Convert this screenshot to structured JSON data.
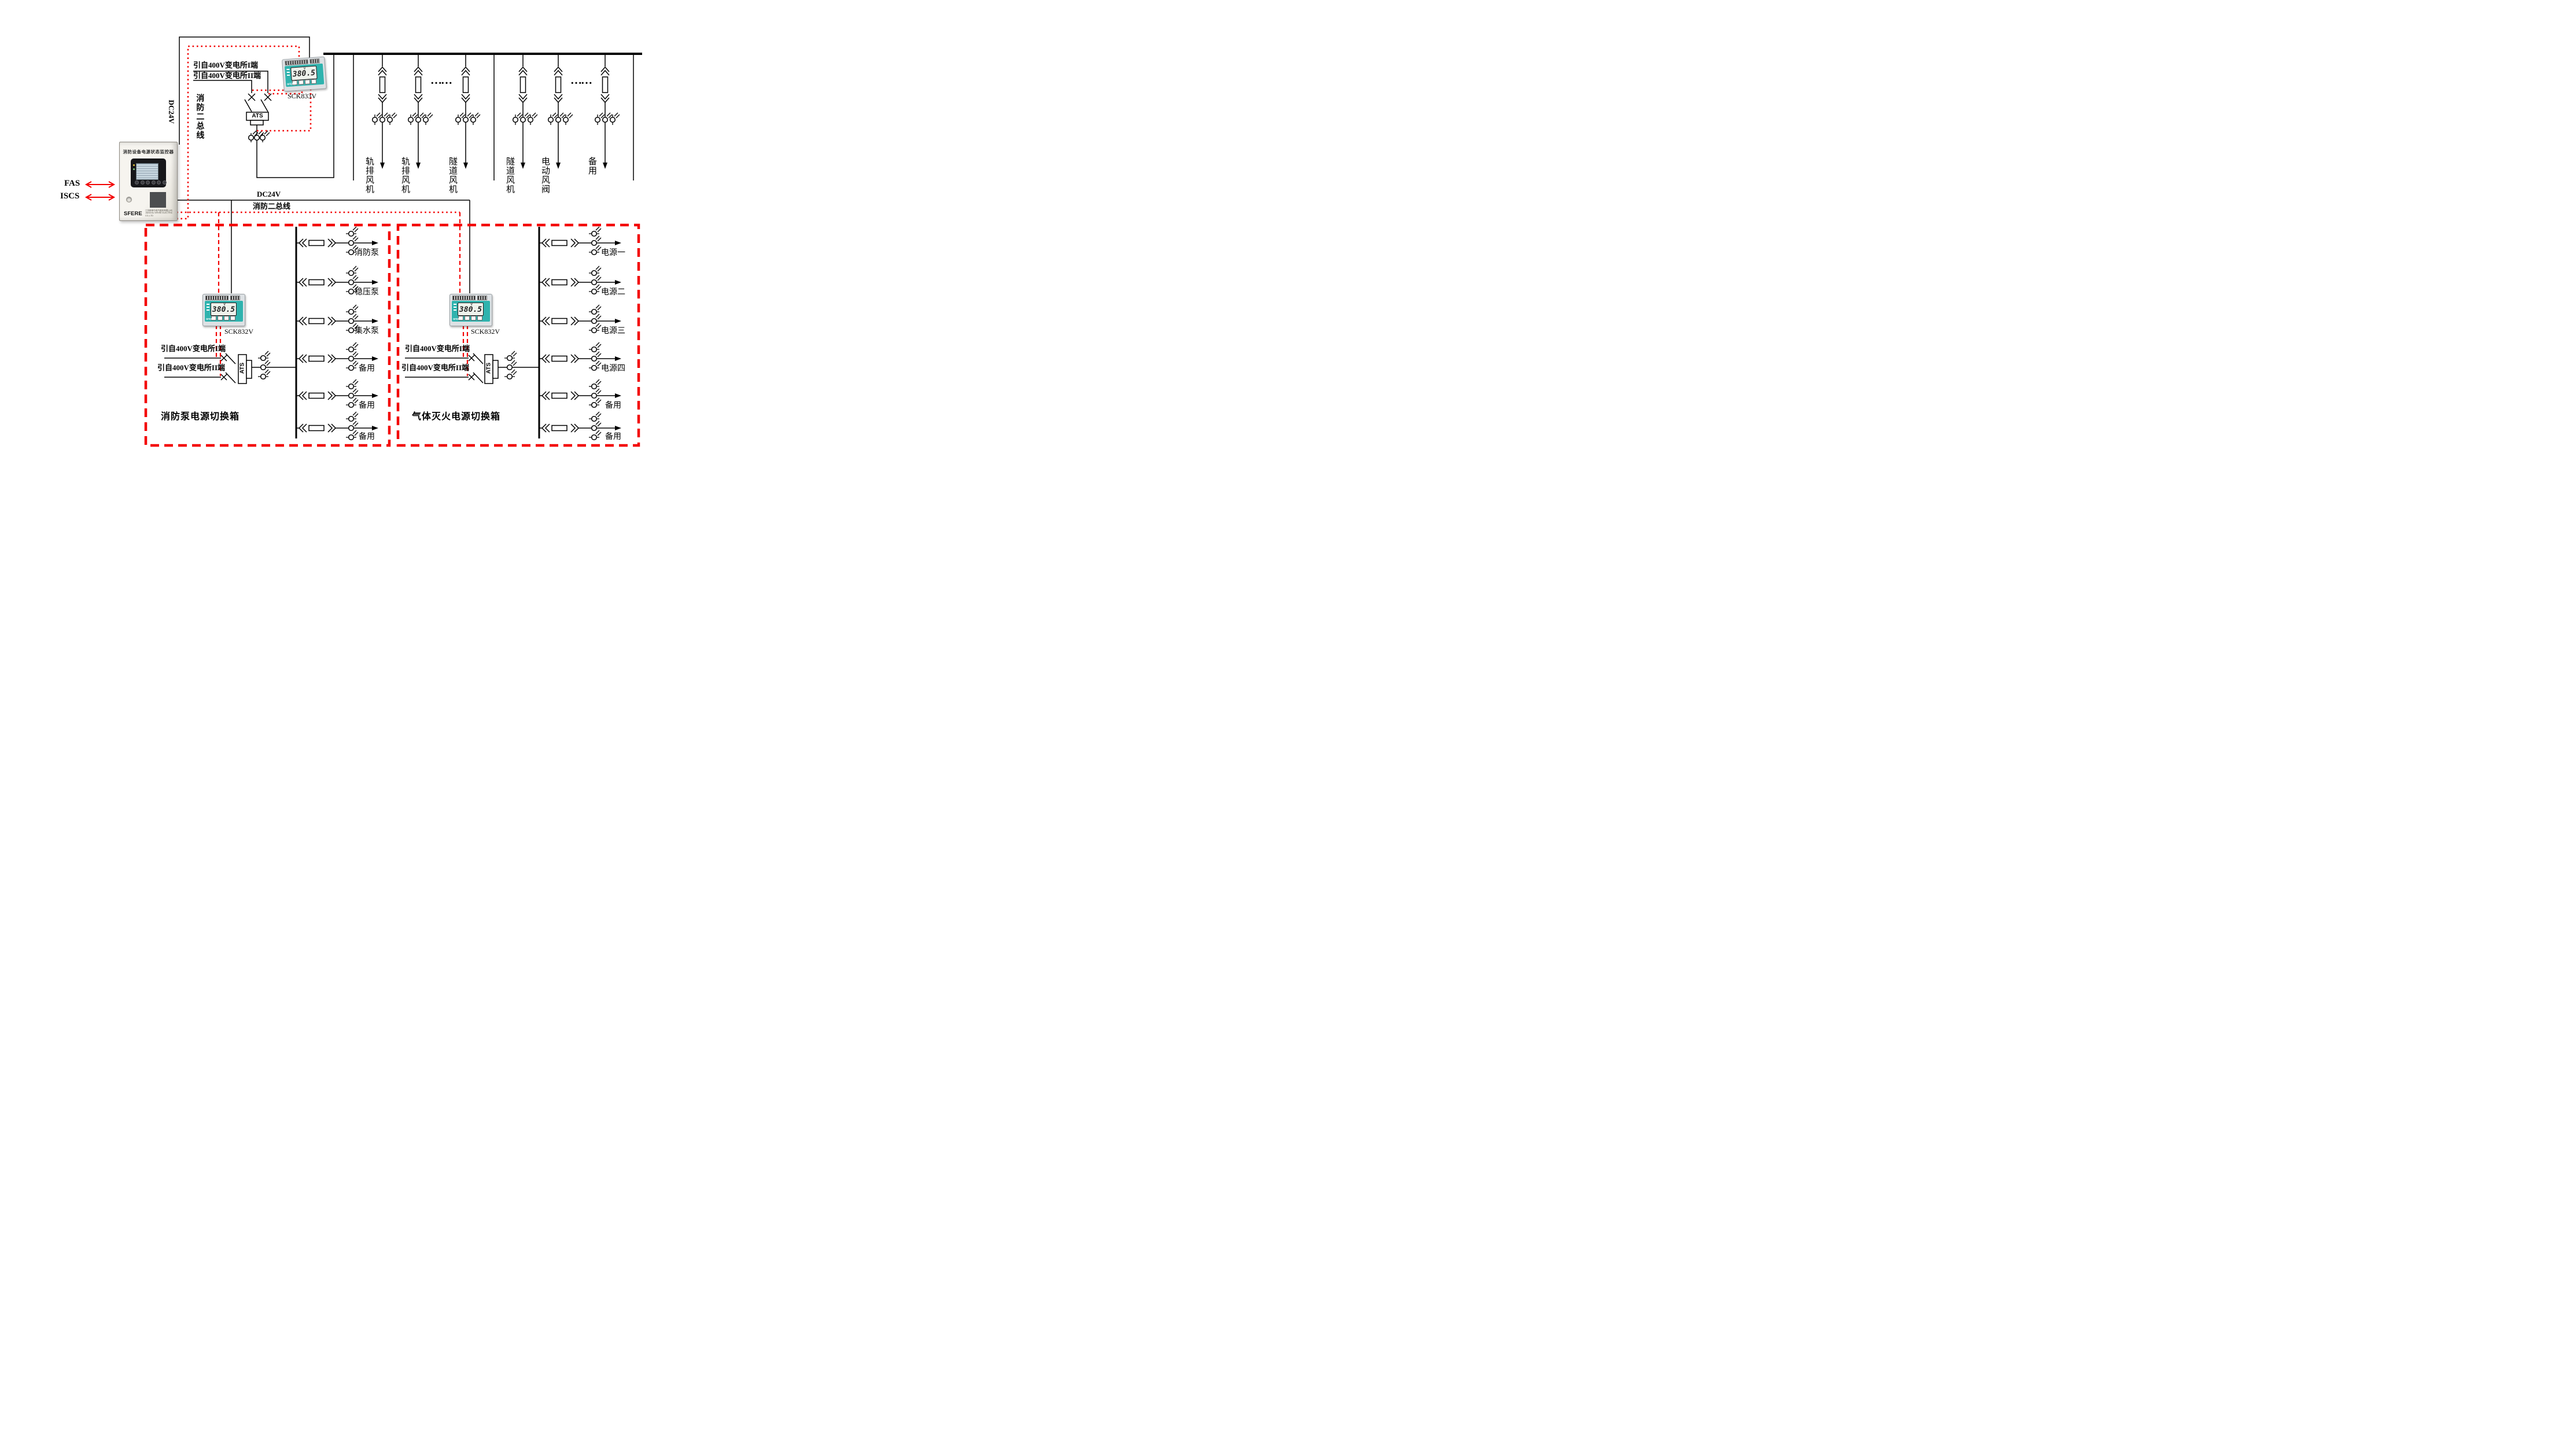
{
  "monitor": {
    "title": "消防设备电源状态监控器",
    "brand": "SFERE",
    "company": "江苏斯菲尔电气股份有限公司 JIANGSU SFERE ELECTRIC CO.,LTD",
    "fas_label": "FAS",
    "iscs_label": "ISCS"
  },
  "meter_display": {
    "value": "380.5",
    "unit": "V",
    "brand": "SFERE"
  },
  "meters": {
    "top_model": "SCK833V",
    "left_model": "SCK832V",
    "right_model": "SCK832V"
  },
  "buses": {
    "dc24v_vertical": "DC24V",
    "fire_bus_vertical": "消防二总线",
    "dc24v_mid": "DC24V",
    "fire_bus_mid": "消防二总线"
  },
  "top_circuit": {
    "source1": "引自400V变电所I端",
    "source2": "引自400V变电所II端",
    "ats_label": "ATS",
    "ellipsis1": "……",
    "ellipsis2": "……",
    "feeders_group1": [
      "轨排风机",
      "轨排风机",
      "隧道风机"
    ],
    "feeders_group2": [
      "隧道风机",
      "电动风阀",
      "备用"
    ]
  },
  "left_box": {
    "title": "消防泵电源切换箱",
    "source1": "引自400V变电所I端",
    "source2": "引自400V变电所II端",
    "ats_label": "ATS",
    "feeders": [
      "消防泵",
      "稳压泵",
      "集水泵",
      "备用",
      "备用",
      "备用"
    ]
  },
  "right_box": {
    "title": "气体灭火电源切换箱",
    "source1": "引自400V变电所I端",
    "source2": "引自400V变电所II端",
    "ats_label": "ATS",
    "feeders": [
      "电源一",
      "电源二",
      "电源三",
      "电源四",
      "备用",
      "备用"
    ]
  },
  "colors": {
    "red": "#f30000",
    "black": "#000000",
    "teal": "#2fb3ae"
  }
}
